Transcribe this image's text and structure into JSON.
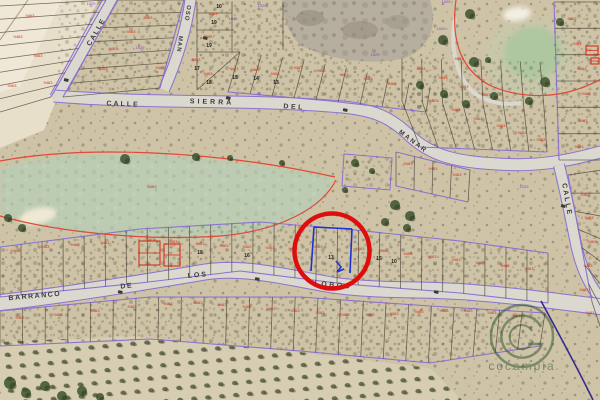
{
  "title": "Aerial cadastral parcel map",
  "colors": {
    "terrain": "#cec3a6",
    "sand": "#e7dfca",
    "fairway_green": "#bccbb2",
    "golf_green": "#afc7a0",
    "bunker": "#f2efe2",
    "road_fill": "#dbd8cf",
    "cadastral_purple": "#8a72cf",
    "parcel_line": "#4a4136",
    "code_red": "#d42310",
    "code_purple": "#8833cc",
    "number_dark": "#222222",
    "boundary_red": "#e04838",
    "selected_blue": "#1f2fd4",
    "highlight_circle_red": "#e00d0d",
    "indigo_line": "#382a8d",
    "tree_green": "#3d5230",
    "watermark_green": "#27502f"
  },
  "streets": [
    {
      "text": "CALLE",
      "x": 98,
      "y": 33,
      "rotate": -60,
      "size": 7,
      "ls": 1.5
    },
    {
      "text": "OSO",
      "x": 186,
      "y": 13,
      "rotate": 99,
      "size": 6,
      "ls": 1
    },
    {
      "text": "MAN",
      "x": 178,
      "y": 44,
      "rotate": 97,
      "size": 6,
      "ls": 1
    },
    {
      "text": "CALLE",
      "x": 123,
      "y": 106,
      "rotate": 2,
      "size": 7,
      "ls": 2
    },
    {
      "text": "SIERRA",
      "x": 212,
      "y": 104,
      "rotate": 2,
      "size": 7,
      "ls": 3
    },
    {
      "text": "DEL",
      "x": 294,
      "y": 109,
      "rotate": 4,
      "size": 7,
      "ls": 2.5
    },
    {
      "text": "MANAR",
      "x": 412,
      "y": 143,
      "rotate": 37,
      "size": 6.5,
      "ls": 2
    },
    {
      "text": "CALLE",
      "x": 565,
      "y": 200,
      "rotate": 80,
      "size": 7,
      "ls": 2
    },
    {
      "text": "BARRANCO",
      "x": 35,
      "y": 298,
      "rotate": -5,
      "size": 7,
      "ls": 1.5
    },
    {
      "text": "DE",
      "x": 127,
      "y": 288,
      "rotate": -6,
      "size": 7,
      "ls": 1.5
    },
    {
      "text": "LOS",
      "x": 198,
      "y": 277,
      "rotate": -5,
      "size": 7,
      "ls": 2
    },
    {
      "text": "LOBOS",
      "x": 333,
      "y": 287,
      "rotate": 5,
      "size": 7,
      "ls": 2.5
    }
  ],
  "parcel_numbers": [
    {
      "text": "10",
      "x": 219,
      "y": 6
    },
    {
      "text": "19",
      "x": 214,
      "y": 22
    },
    {
      "text": "19",
      "x": 209,
      "y": 45
    },
    {
      "text": "17",
      "x": 197,
      "y": 68
    },
    {
      "text": "18",
      "x": 209,
      "y": 82
    },
    {
      "text": "15",
      "x": 235,
      "y": 77
    },
    {
      "text": "14",
      "x": 256,
      "y": 78
    },
    {
      "text": "13",
      "x": 276,
      "y": 82
    },
    {
      "text": "18",
      "x": 200,
      "y": 252
    },
    {
      "text": "16",
      "x": 247,
      "y": 255
    },
    {
      "text": "13",
      "x": 331,
      "y": 257
    },
    {
      "text": "15",
      "x": 379,
      "y": 258
    },
    {
      "text": "10",
      "x": 394,
      "y": 261
    }
  ],
  "selected_parcel": {
    "number": "13"
  },
  "red_code_sample": "9463",
  "purple_code_sample": "1029",
  "red_code_positions": [
    [
      18,
      38
    ],
    [
      38,
      57
    ],
    [
      12,
      87
    ],
    [
      48,
      84
    ],
    [
      30,
      17
    ],
    [
      113,
      50
    ],
    [
      131,
      33
    ],
    [
      148,
      19
    ],
    [
      160,
      69
    ],
    [
      103,
      70
    ],
    [
      213,
      15
    ],
    [
      208,
      38
    ],
    [
      196,
      61
    ],
    [
      208,
      75
    ],
    [
      234,
      70
    ],
    [
      255,
      71
    ],
    [
      275,
      75
    ],
    [
      298,
      69
    ],
    [
      321,
      72
    ],
    [
      344,
      76
    ],
    [
      368,
      80
    ],
    [
      392,
      85
    ],
    [
      421,
      70
    ],
    [
      443,
      79
    ],
    [
      464,
      88
    ],
    [
      486,
      96
    ],
    [
      433,
      102
    ],
    [
      456,
      111
    ],
    [
      478,
      120
    ],
    [
      501,
      127
    ],
    [
      522,
      134
    ],
    [
      541,
      141
    ],
    [
      459,
      60
    ],
    [
      572,
      20
    ],
    [
      577,
      45
    ],
    [
      582,
      70
    ],
    [
      586,
      95
    ],
    [
      583,
      122
    ],
    [
      579,
      148
    ],
    [
      585,
      196
    ],
    [
      589,
      219
    ],
    [
      592,
      243
    ],
    [
      588,
      267
    ],
    [
      584,
      291
    ],
    [
      590,
      314
    ],
    [
      408,
      165
    ],
    [
      433,
      170
    ],
    [
      457,
      176
    ],
    [
      152,
      188
    ],
    [
      15,
      252
    ],
    [
      45,
      248
    ],
    [
      75,
      246
    ],
    [
      105,
      244
    ],
    [
      150,
      241
    ],
    [
      173,
      243
    ],
    [
      200,
      245
    ],
    [
      224,
      247
    ],
    [
      247,
      248
    ],
    [
      270,
      249
    ],
    [
      293,
      250
    ],
    [
      318,
      248
    ],
    [
      360,
      250
    ],
    [
      383,
      252
    ],
    [
      408,
      255
    ],
    [
      432,
      258
    ],
    [
      456,
      261
    ],
    [
      480,
      264
    ],
    [
      505,
      267
    ],
    [
      529,
      270
    ],
    [
      20,
      319
    ],
    [
      58,
      316
    ],
    [
      95,
      312
    ],
    [
      132,
      308
    ],
    [
      168,
      305
    ],
    [
      198,
      304
    ],
    [
      222,
      306
    ],
    [
      247,
      308
    ],
    [
      271,
      310
    ],
    [
      295,
      312
    ],
    [
      320,
      314
    ],
    [
      345,
      316
    ],
    [
      370,
      316
    ],
    [
      394,
      315
    ],
    [
      419,
      313
    ],
    [
      444,
      312
    ],
    [
      468,
      312
    ],
    [
      492,
      314
    ],
    [
      516,
      317
    ]
  ],
  "purple_code_positions": [
    [
      91,
      5
    ],
    [
      140,
      49
    ],
    [
      233,
      20
    ],
    [
      441,
      30
    ],
    [
      446,
      3
    ],
    [
      375,
      56
    ],
    [
      524,
      188
    ],
    [
      262,
      7
    ]
  ],
  "watermark": {
    "text": "cocampia"
  }
}
